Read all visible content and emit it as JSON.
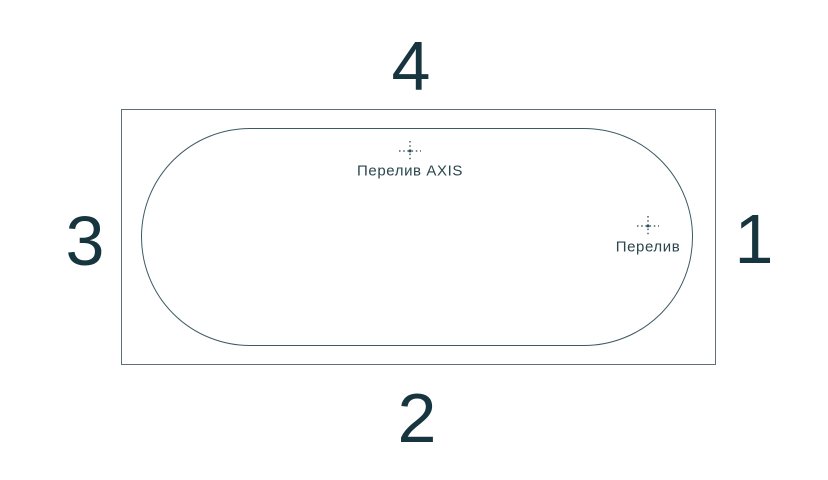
{
  "diagram": {
    "title": "bathtub-top-view-side-scheme",
    "side_numbers": {
      "top": "4",
      "bottom": "2",
      "left": "3",
      "right": "1"
    },
    "markers": {
      "overflow_axis": {
        "label": "Перелив AXIS"
      },
      "overflow": {
        "label": "Перелив"
      }
    },
    "colors": {
      "background": "#ffffff",
      "outer_rect_line": "#5d7077",
      "tub_line": "#3d5a63",
      "text": "#17353e",
      "marker_dots": "#46626b"
    }
  }
}
